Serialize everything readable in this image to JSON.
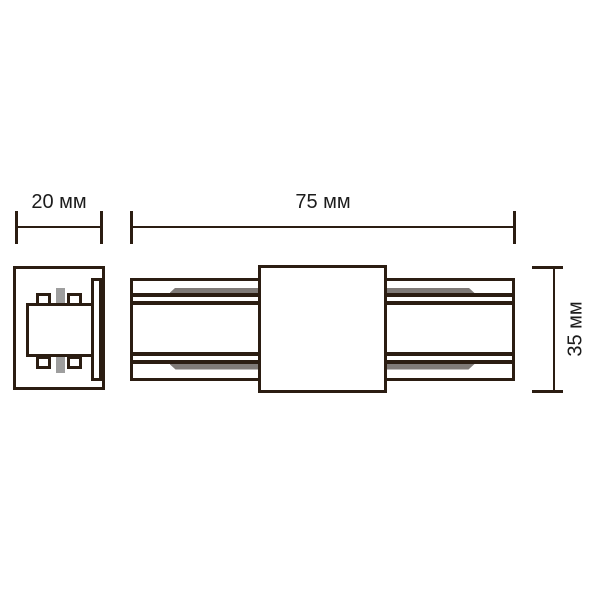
{
  "drawing": {
    "type": "technical-drawing",
    "subject": "track-connector",
    "dimensions": {
      "width": "20 мм",
      "length": "75 мм",
      "height": "35 мм"
    },
    "colors": {
      "stroke": "#2b1d12",
      "conductor_gray": "#7f7a77",
      "pin_gray": "#9e9e9e",
      "text": "#1c1c1c",
      "background": "#ffffff"
    }
  }
}
